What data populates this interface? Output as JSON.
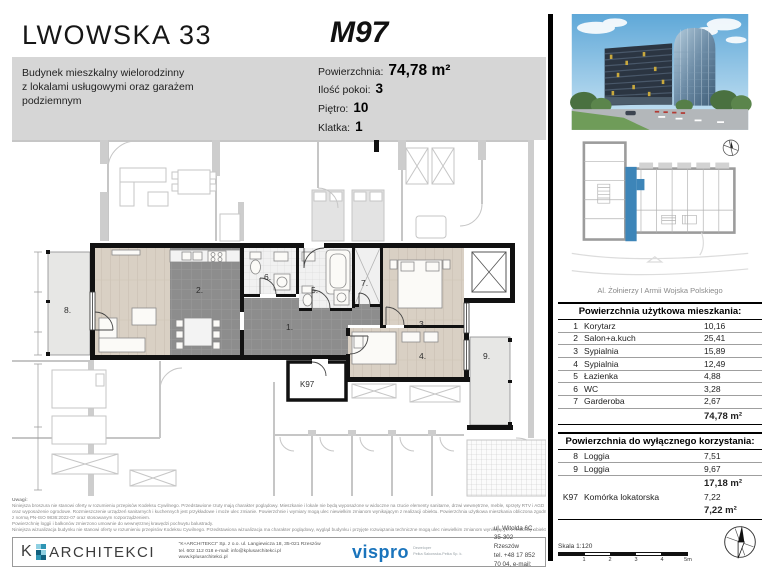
{
  "header": {
    "project_title": "LWOWSKA 33",
    "building_description_lines": [
      "Budynek mieszkalny wielorodzinny",
      "z lokalami usługowymi oraz garażem",
      "podziemnym"
    ],
    "unit_code": "M97",
    "specs": [
      {
        "label": "Powierzchnia:",
        "value": "74,78 m²"
      },
      {
        "label": "Ilość pokoi:",
        "value": "3"
      },
      {
        "label": "Piętro:",
        "value": "10"
      },
      {
        "label": "Klatka:",
        "value": "1"
      }
    ]
  },
  "floorplan": {
    "rooms": [
      {
        "label": "1."
      },
      {
        "label": "2."
      },
      {
        "label": "3."
      },
      {
        "label": "4."
      },
      {
        "label": "5."
      },
      {
        "label": "6."
      },
      {
        "label": "7."
      },
      {
        "label": "8."
      },
      {
        "label": "9."
      }
    ],
    "storage_label": "K97"
  },
  "siteplan": {
    "street_label": "Al. Żołnierzy I Armii Wojska Polskiego",
    "highlight_color": "#3d85b8"
  },
  "area_tables": {
    "usable": {
      "title": "Powierzchnia użytkowa mieszkania:",
      "rows": [
        {
          "no": "1",
          "name": "Korytarz",
          "value": "10,16"
        },
        {
          "no": "2",
          "name": "Salon+a.kuch",
          "value": "25,41"
        },
        {
          "no": "3",
          "name": "Sypialnia",
          "value": "15,89"
        },
        {
          "no": "4",
          "name": "Sypialnia",
          "value": "12,49"
        },
        {
          "no": "5",
          "name": "Łazienka",
          "value": "4,88"
        },
        {
          "no": "6",
          "name": "WC",
          "value": "3,28"
        },
        {
          "no": "7",
          "name": "Garderoba",
          "value": "2,67"
        }
      ],
      "total": "74,78 m²"
    },
    "exclusive": {
      "title": "Powierzchnia do wyłącznego korzystania:",
      "rows": [
        {
          "no": "8",
          "name": "Loggia",
          "value": "7,51"
        },
        {
          "no": "9",
          "name": "Loggia",
          "value": "9,67"
        }
      ],
      "subtotal": "17,18 m²",
      "extra_row": {
        "no": "K97",
        "name": "Komórka lokatorska",
        "value": "7,22"
      },
      "total": "7,22 m²"
    }
  },
  "scale_bar": {
    "label": "Skala 1:120",
    "ticks": [
      "1",
      "2",
      "3",
      "4",
      "5m"
    ]
  },
  "disclaimer": {
    "heading": "Uwagi:",
    "lines": [
      "Niniejsza broszura nie stanowi oferty w rozumieniu przepisów Kodeksu Cywilnego. Przedstawione rzuty mają charakter poglądowy. Mieszkanie i lokale nie będą wyposażone w widoczne na rzucie elementy sanitarne, drzwi wewnętrzne, meble, sprzęty RTV i AGD",
      "oraz wyposażenie ogrodowe. Rozmieszczenie urządzeń sanitarnych i kuchennych jest przykładowe i może ulec zmianie. Powierzchnie i wymiary mogą ulec niewielkim zmianom wynikającym z realizacji obiektu. Powierzchnia użytkowa mieszkania obliczona zgodnie",
      "z normą PN-ISO 9836:2022-07 oraz stosowanym rozporządzeniem.",
      "Powierzchnię loggii i balkonów zmierzono umownie do wewnętrznej krawędzi pochwytu balustrady.",
      "Niniejsza wizualizacja budynku nie stanowi oferty w rozumieniu przepisów Kodeksu Cywilnego. Przedstawiona wizualizacja ma charakter poglądowy, wygląd budynku i przyjęte rozwiązania techniczne mogą ulec niewielkim zmianom wynikającym z realizacji obiektu."
    ]
  },
  "footer": {
    "karchitekci": {
      "logo_text_k": "K",
      "logo_text": "ARCHITEKCI",
      "contact_lines": [
        "\"K+ARCHITEKCI\" Sp. z o.o. ul. Langiewicza 18, 35-021 Rzeszów",
        "tel. 602 112 018 e-mail: info@kplusarchitekci.pl",
        "www.kplusarchitekci.pl"
      ]
    },
    "vispro": {
      "logo_text": "vispro",
      "tagline_lines": [
        "Deweloper",
        "Pełka Sakowska-Pełka Sp. k."
      ],
      "contact_lines": [
        "ul. Witolda 6C, 35-302 Rzeszów",
        "tel. +48 17 852 70 04, e-mail: biuro@vispro.pl"
      ]
    }
  }
}
